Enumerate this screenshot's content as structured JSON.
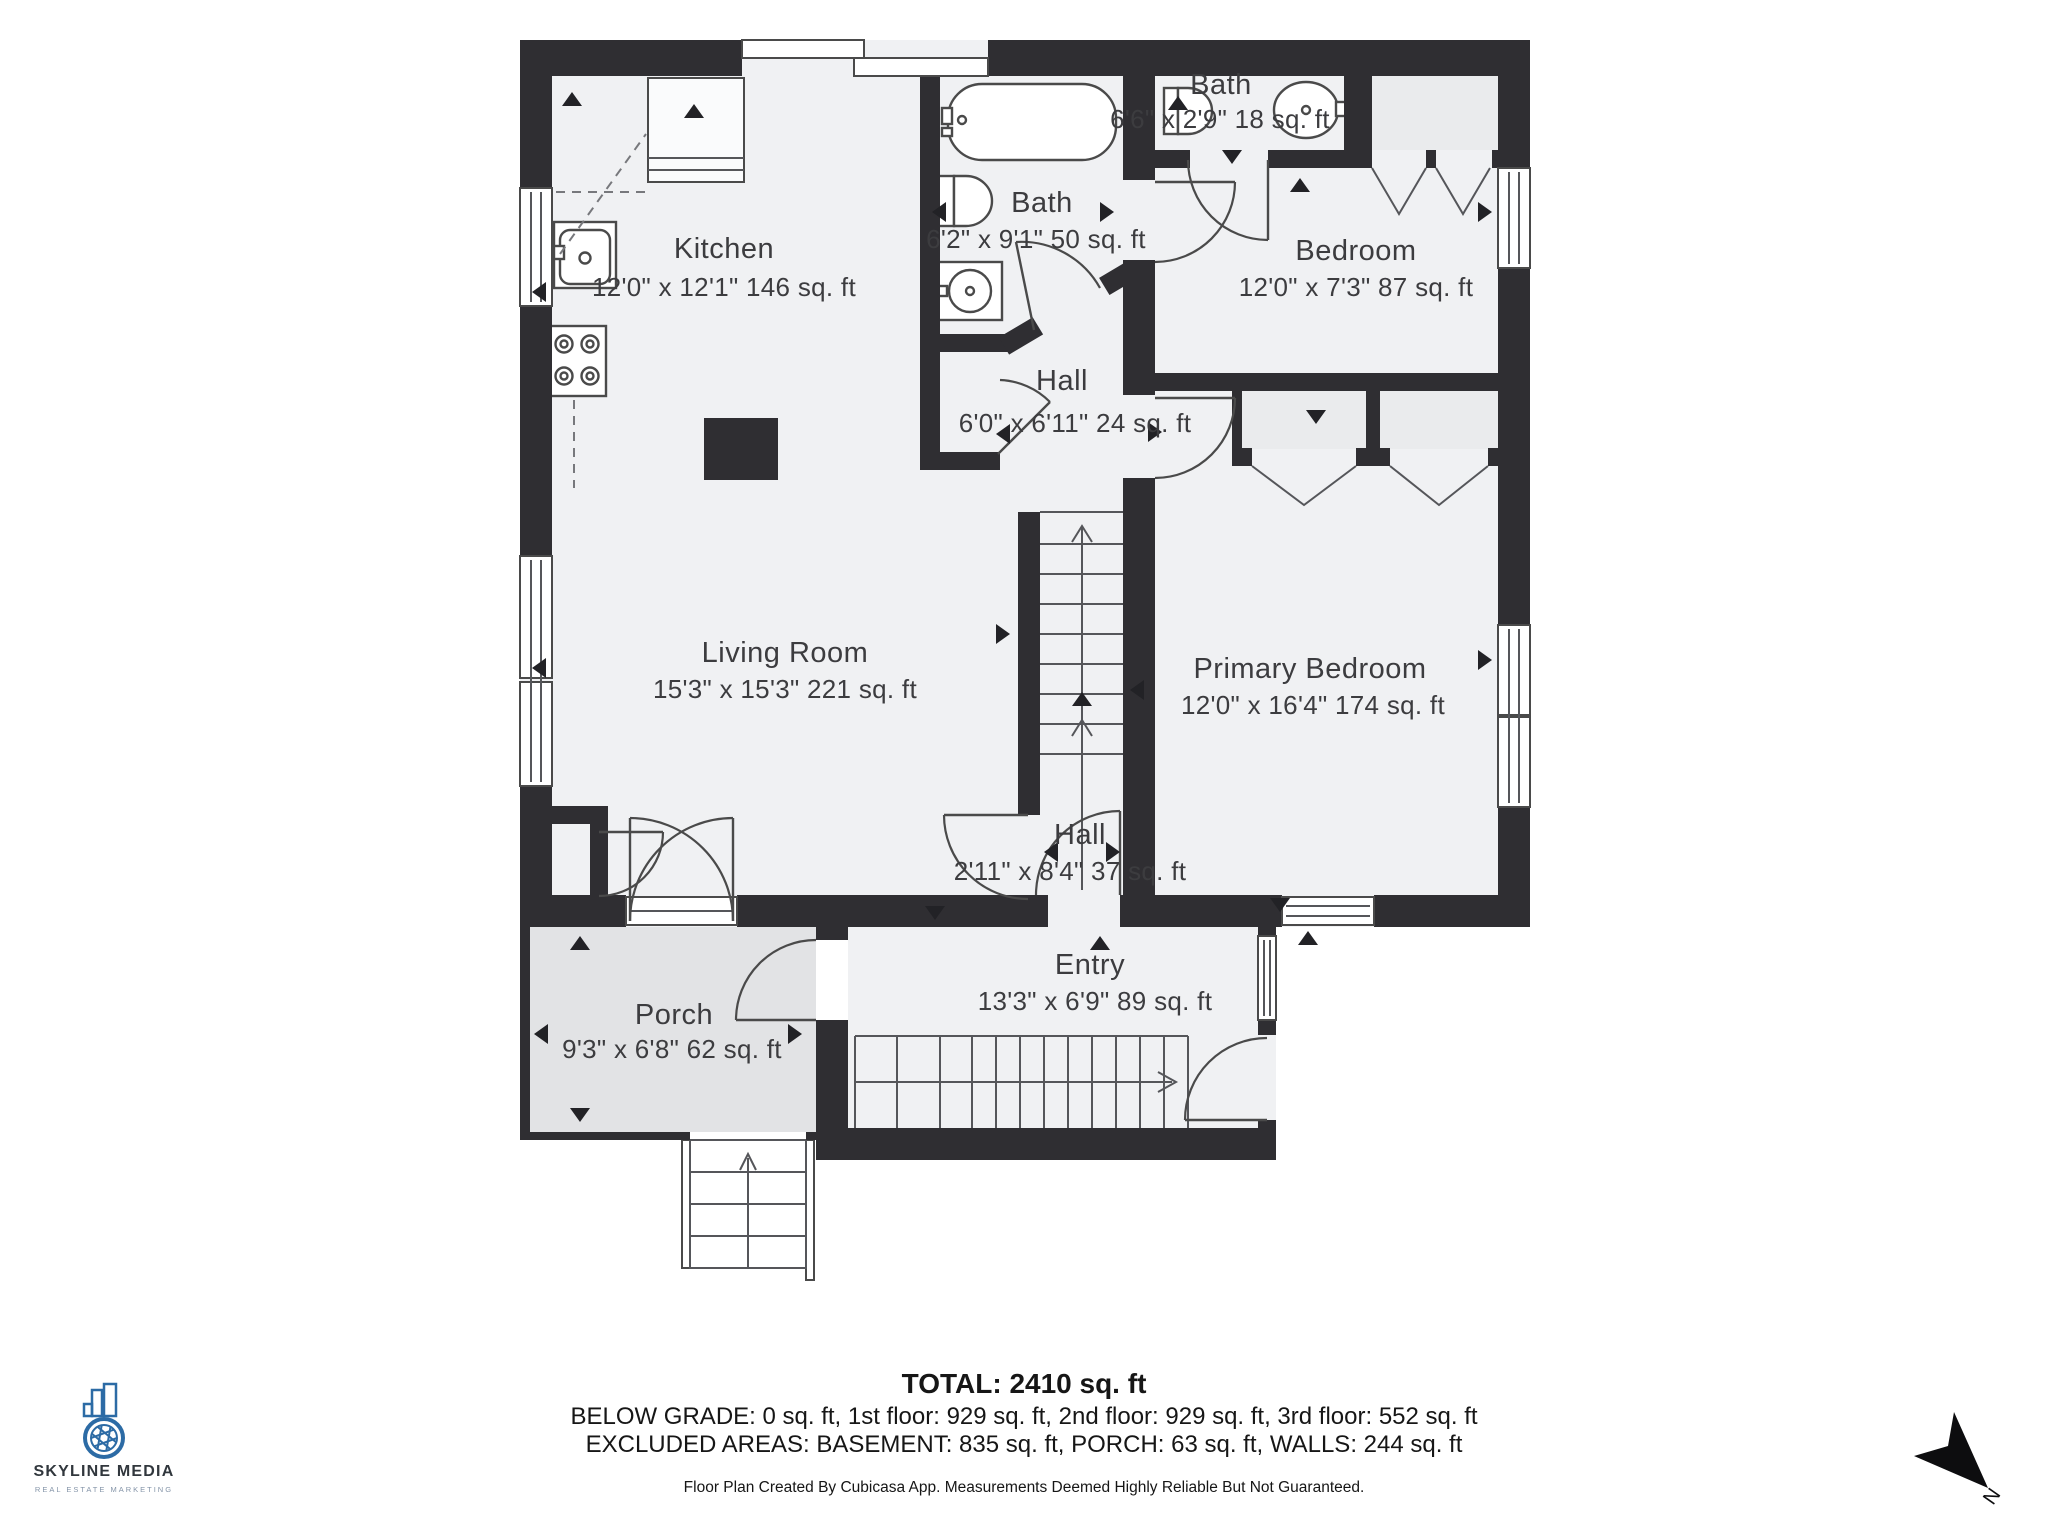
{
  "rooms": {
    "kitchen": {
      "name": "Kitchen",
      "dims": "12'0\" x 12'1\" 146 sq. ft"
    },
    "bath_main": {
      "name": "Bath",
      "dims": "6'2\" x 9'1\" 50 sq. ft"
    },
    "bath_small": {
      "name": "Bath",
      "dims": "6'6\" x 2'9\" 18 sq. ft"
    },
    "bedroom": {
      "name": "Bedroom",
      "dims": "12'0\" x 7'3\" 87 sq. ft"
    },
    "hall_upper": {
      "name": "Hall",
      "dims": "6'0\" x 6'11\" 24 sq. ft"
    },
    "living_room": {
      "name": "Living Room",
      "dims": "15'3\" x 15'3\" 221 sq. ft"
    },
    "primary_bedroom": {
      "name": "Primary Bedroom",
      "dims": "12'0\" x 16'4\" 174 sq. ft"
    },
    "hall_lower": {
      "name": "Hall",
      "dims": "2'11\" x 8'4\" 37 sq. ft"
    },
    "entry": {
      "name": "Entry",
      "dims": "13'3\" x 6'9\" 89 sq. ft"
    },
    "porch": {
      "name": "Porch",
      "dims": "9'3\" x 6'8\" 62 sq. ft"
    }
  },
  "summary": {
    "total": "TOTAL: 2410 sq. ft",
    "floors": "BELOW GRADE: 0 sq. ft, 1st floor: 929 sq. ft, 2nd floor: 929 sq. ft, 3rd floor: 552 sq. ft",
    "excluded": "EXCLUDED AREAS: BASEMENT: 835 sq. ft, PORCH: 63 sq. ft, WALLS: 244 sq. ft",
    "disclaimer": "Floor Plan Created By Cubicasa App. Measurements Deemed Highly Reliable But Not Guaranteed."
  },
  "branding": {
    "company": "SKYLINE MEDIA",
    "tagline": "REAL ESTATE MARKETING"
  },
  "compass": {
    "label": "N"
  },
  "colors": {
    "wall": "#2f2e32",
    "floor": "#f0f1f3",
    "porch": "#e2e3e5",
    "closet": "#eaebed",
    "accent_blue": "#2c6ba5",
    "text": "#3c3c3f",
    "footer_text": "#161616",
    "logo_text": "#31373d",
    "tagline": "#8494a8"
  }
}
